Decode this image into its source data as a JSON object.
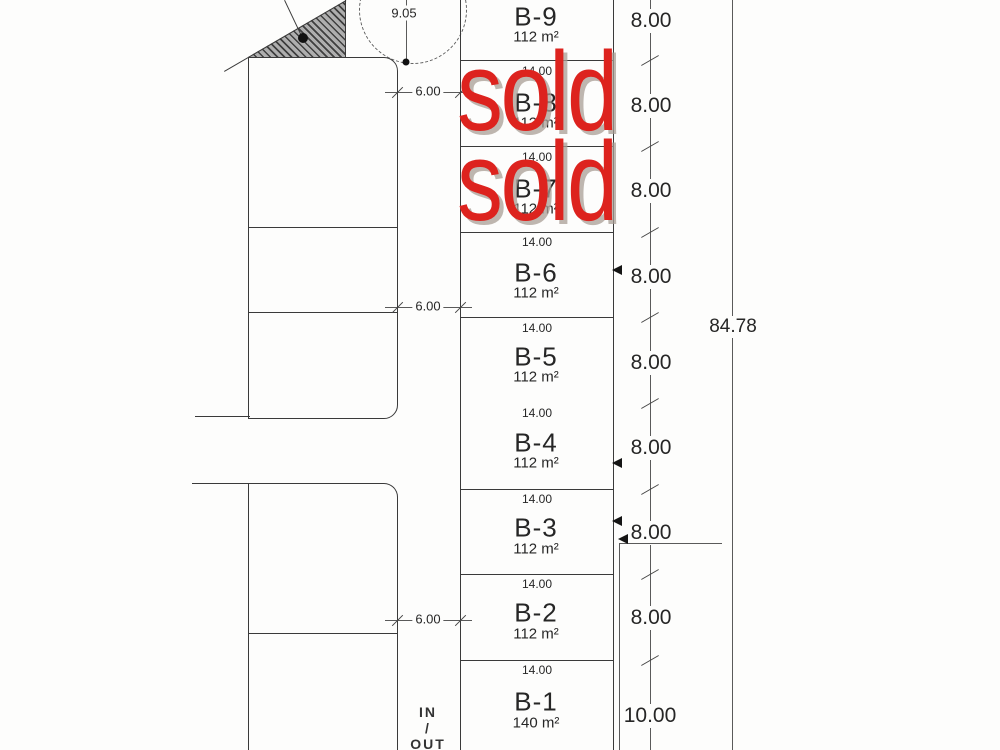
{
  "plots": [
    {
      "id": "B-9",
      "area": "112 m²",
      "depth": "8.00"
    },
    {
      "id": "B-8",
      "area": "112 m²",
      "width": "14.00",
      "depth": "8.00",
      "status": "sold"
    },
    {
      "id": "B-7",
      "area": "112 m²",
      "width": "14.00",
      "depth": "8.00",
      "status": "sold"
    },
    {
      "id": "B-6",
      "area": "112 m²",
      "width": "14.00",
      "depth": "8.00"
    },
    {
      "id": "B-5",
      "area": "112 m²",
      "width": "14.00",
      "depth": "8.00"
    },
    {
      "id": "B-4",
      "area": "112 m²",
      "width": "14.00",
      "depth": "8.00"
    },
    {
      "id": "B-3",
      "area": "112 m²",
      "width": "14.00",
      "depth": "8.00"
    },
    {
      "id": "B-2",
      "area": "112 m²",
      "width": "14.00",
      "depth": "8.00"
    },
    {
      "id": "B-1",
      "area": "140 m²",
      "width": "14.00",
      "depth": "10.00"
    }
  ],
  "dimensions": {
    "total_depth": "84.78",
    "top_offset": "9.05",
    "road_width_labels": [
      "6.00",
      "6.00",
      "6.00"
    ]
  },
  "access": {
    "line1": "IN",
    "line2": "/",
    "line3": "OUT"
  },
  "stamps": {
    "sold_text": "sold",
    "color": "#dd231e"
  }
}
